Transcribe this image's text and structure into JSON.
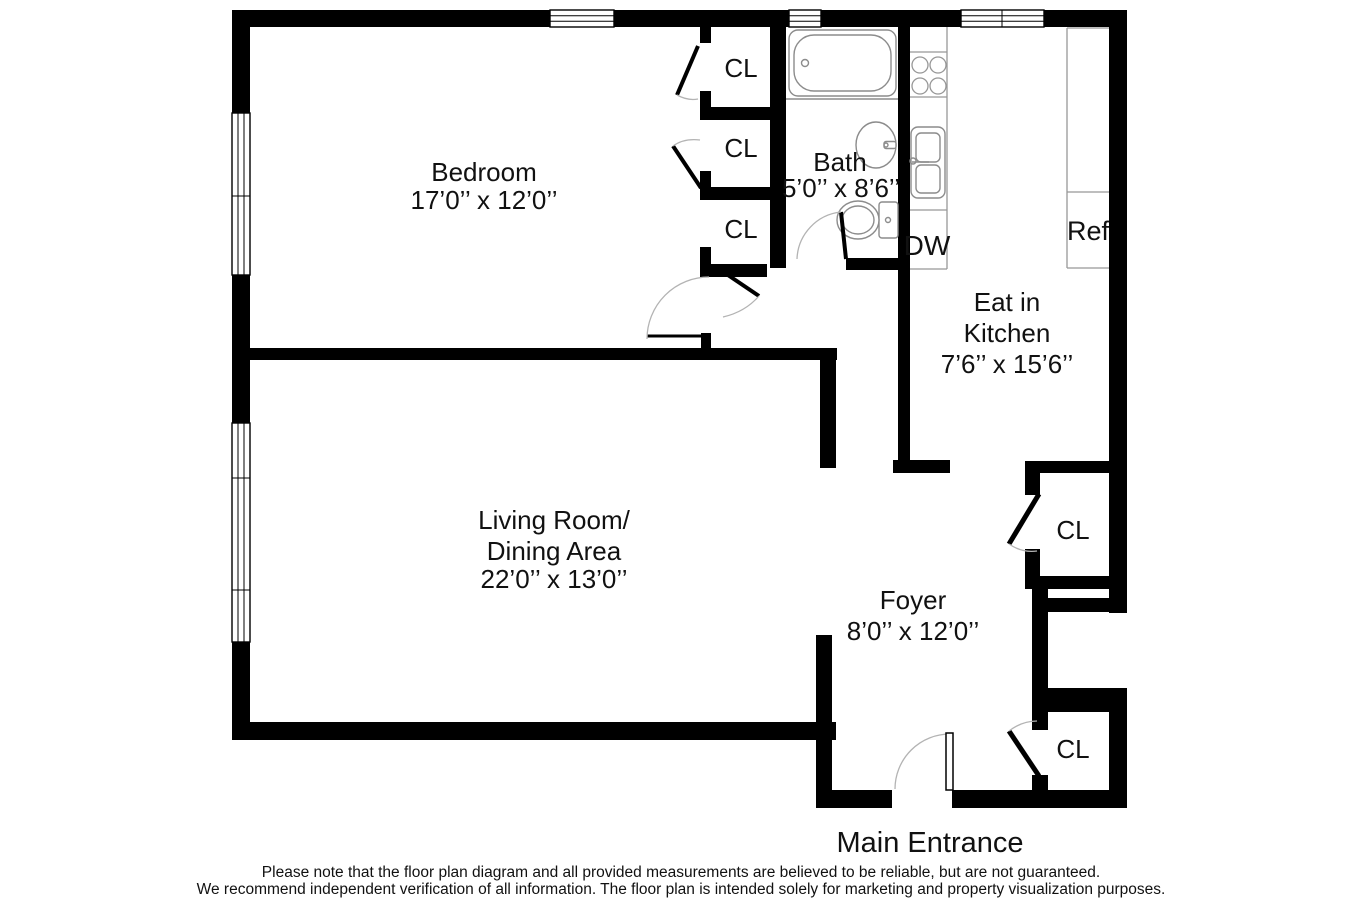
{
  "floor_plan": {
    "rooms": {
      "bedroom": {
        "name": "Bedroom",
        "dimensions": "17’0’’ x 12’0’’"
      },
      "bath": {
        "name": "Bath",
        "dimensions": "5’0’’ x 8’6’’"
      },
      "kitchen": {
        "name_line1": "Eat in",
        "name_line2": "Kitchen",
        "dimensions": "7’6’’ x 15’6’’"
      },
      "living": {
        "name_line1": "Living Room/",
        "name_line2": "Dining Area",
        "dimensions": "22’0’’ x 13’0’’"
      },
      "foyer": {
        "name": "Foyer",
        "dimensions": "8’0’’ x 12’0’’"
      }
    },
    "closet_label": "CL",
    "appliances": {
      "dishwasher": "DW",
      "refrigerator": "Ref"
    },
    "entrance_label": "Main Entrance",
    "disclaimer": {
      "line1": "Please note that the floor plan diagram and all provided measurements are believed to be reliable, but are not guaranteed.",
      "line2": "We recommend independent verification of all information. The floor plan is intended solely for marketing and property visualization purposes."
    },
    "colors": {
      "wall": "#000000",
      "background": "#ffffff",
      "fixture_stroke": "#8c8c8c",
      "door_arc_stroke": "#b3b3b3",
      "text": "#111111"
    }
  }
}
